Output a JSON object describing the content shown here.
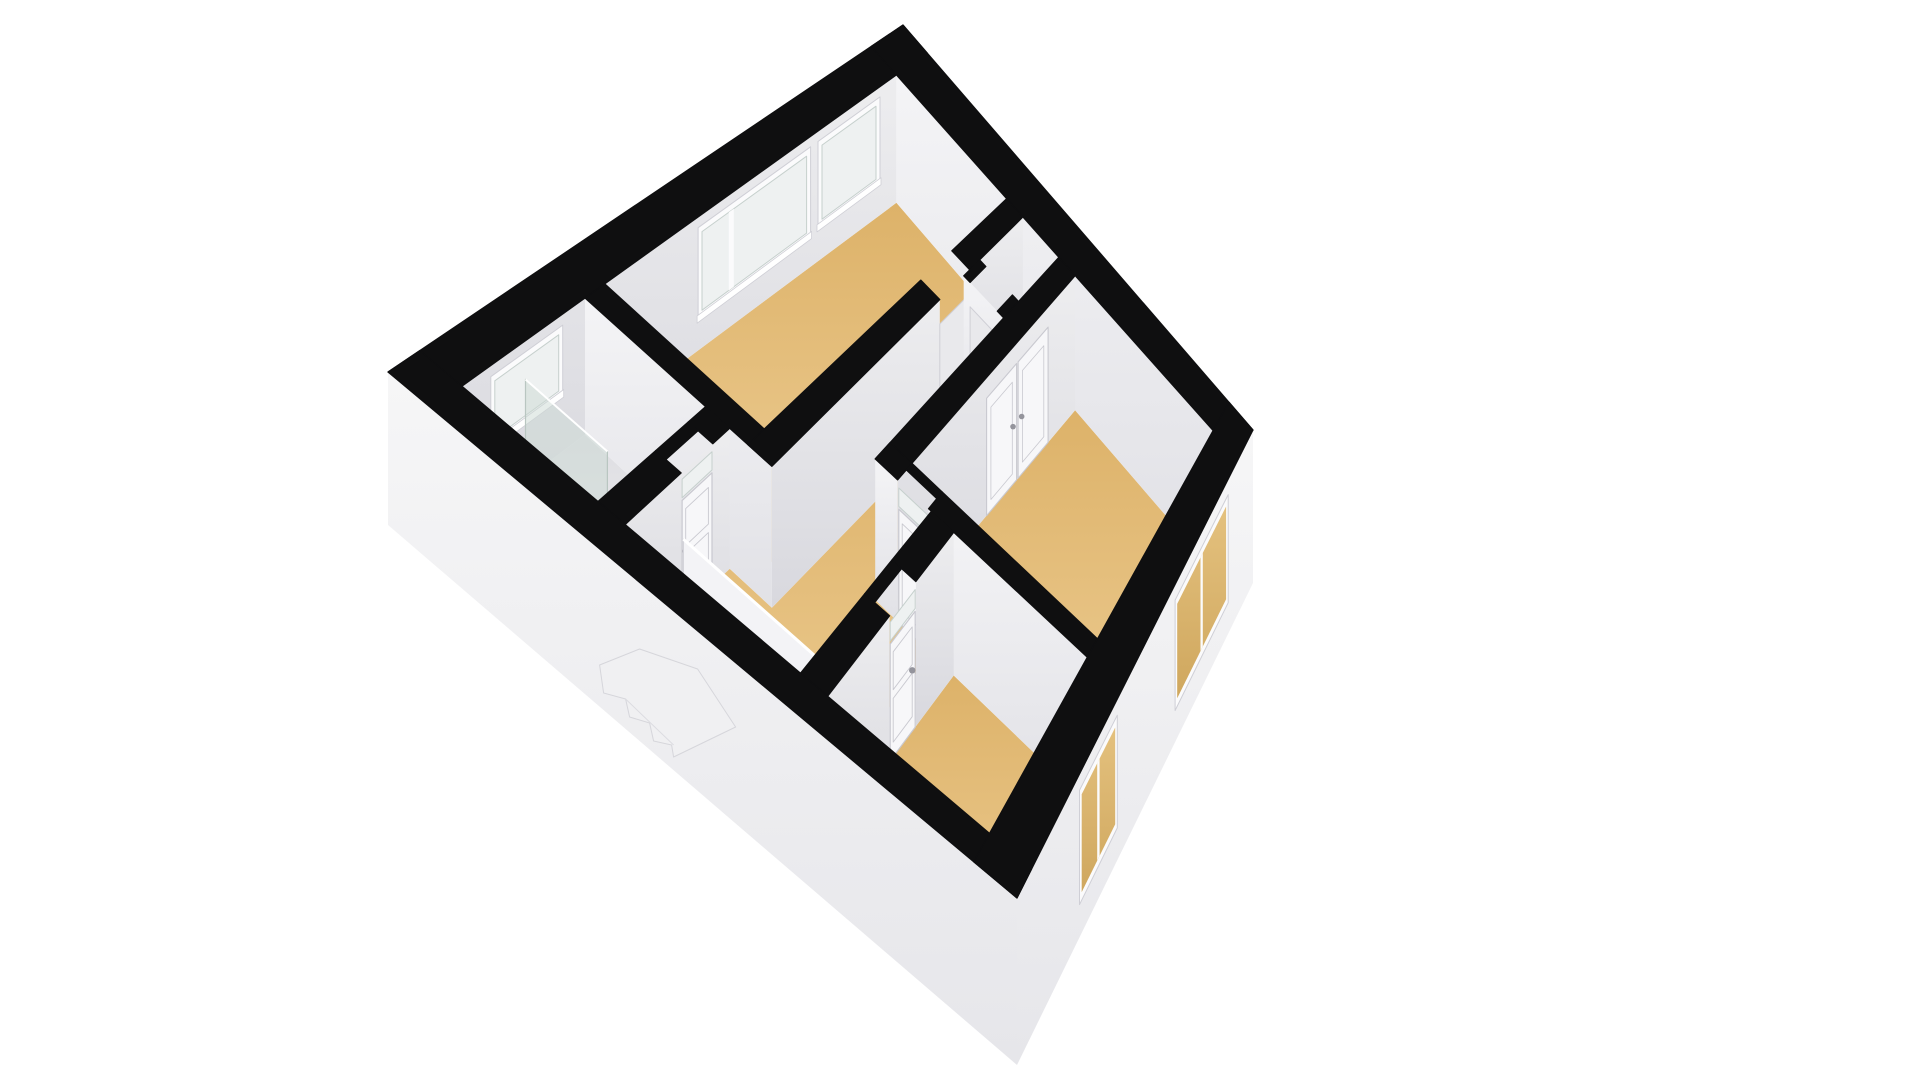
{
  "page": {
    "background": "#ffffff",
    "kind": "3d-floor-plan-render",
    "floor_label": "upper-floor"
  },
  "projection": {
    "corners": {
      "n": [
        903,
        25
      ],
      "w": [
        388,
        372
      ],
      "e": [
        1253,
        430
      ],
      "s": [
        1017,
        898
      ]
    },
    "plan_width": 10,
    "plan_depth": 9,
    "wall_px": {
      "base": 126,
      "grow": 14,
      "slab": 13
    }
  },
  "colors": {
    "band": "#0f0f10",
    "wallA_hi": "#ededef",
    "wallA_lo": "#d8d8de",
    "wallB_hi": "#f4f4f6",
    "wallB_lo": "#e1e1e6",
    "ext_hi": "#f6f6f7",
    "ext_lo": "#e6e6ea",
    "floor_hi": "#eece95",
    "floor_lo": "#ddb269",
    "bath_hi": "#f0f0f2",
    "bath_lo": "#dedee2",
    "closet_hi": "#ececee",
    "closet_lo": "#dcdce0",
    "frame": "#fbfbfc",
    "frame_edge": "#cfcfd6",
    "glass": "#eef1f1",
    "glass_edge": "#c6d0cd",
    "glass_ext_hi": "#e4c17e",
    "glass_ext_lo": "#cfa75e",
    "door": "#f7f7f9",
    "door_edge": "#c9c9d0",
    "handle": "#94949c",
    "stair_a": "#ffffff",
    "stair_b": "#f1f1f4",
    "stair_edge": "#cdcdd4",
    "opening_back": "#e9e9ec",
    "shower_glass": "rgba(203,217,212,0.5)",
    "shower_edge": "#b9c6c1",
    "fixture": "#fdfdfe",
    "fixture_edge": "#c9c9cf"
  },
  "plan": {
    "floors": [
      {
        "name": "floor-bedroom-top",
        "rect": [
          0.62,
          0.62,
          6.5,
          3.32
        ],
        "kind": "wood"
      },
      {
        "name": "floor-bathroom",
        "rect": [
          6.9,
          0.62,
          9.38,
          2.62
        ],
        "kind": "bath"
      },
      {
        "name": "floor-closet",
        "rect": [
          0.62,
          3.72,
          1.7,
          4.6
        ],
        "kind": "closet"
      },
      {
        "name": "floor-bedroom-right",
        "rect": [
          0.62,
          5.0,
          5.15,
          8.38
        ],
        "kind": "wood"
      },
      {
        "name": "floor-bedroom-bottom",
        "rect": [
          5.55,
          6.0,
          9.38,
          8.38
        ],
        "kind": "wood"
      },
      {
        "name": "floor-hallway-landing",
        "poly": [
          [
            2.1,
            3.72
          ],
          [
            6.9,
            3.72
          ],
          [
            6.9,
            3.02
          ],
          [
            9.38,
            3.02
          ],
          [
            9.38,
            5.6
          ],
          [
            5.55,
            5.6
          ],
          [
            5.55,
            4.6
          ],
          [
            2.1,
            4.6
          ]
        ],
        "kind": "wood"
      }
    ],
    "interior_windows": [
      {
        "name": "window-bedroom-top-narrow",
        "b": 0.62,
        "span": [
          0.95,
          2.2
        ],
        "sill": 0.3,
        "head": 0.9,
        "mullions": []
      },
      {
        "name": "window-bedroom-top-large",
        "b": 0.62,
        "span": [
          2.35,
          4.62
        ],
        "sill": 0.28,
        "head": 0.9,
        "mullions": [
          3.95
        ]
      },
      {
        "name": "window-bathroom",
        "b": 0.62,
        "span": [
          7.35,
          8.8
        ],
        "sill": 0.46,
        "head": 0.9,
        "mullions": []
      }
    ],
    "walls": [
      {
        "name": "wall-divider-bed-top-bath",
        "type": "B",
        "a": [
          6.5,
          6.9
        ],
        "b": [
          0.62,
          3.72
        ],
        "face_a": 6.9,
        "segments": [
          [
            0.62,
            3.72
          ]
        ]
      },
      {
        "name": "wall-bed-top-south",
        "type": "A",
        "b": [
          3.32,
          3.72
        ],
        "a": [
          0.62,
          6.9
        ],
        "face_b": 3.72,
        "segments": [
          [
            0.62,
            1.95
          ],
          [
            2.7,
            6.9
          ]
        ],
        "opening": [
          1.95,
          2.7
        ]
      },
      {
        "name": "wall-bathroom-south",
        "type": "A",
        "b": [
          2.62,
          3.02
        ],
        "a": [
          6.9,
          9.38
        ],
        "face_b": 3.02,
        "segments": [
          [
            6.9,
            7.3
          ],
          [
            8.05,
            9.38
          ]
        ],
        "door_gap": [
          7.3,
          8.05
        ]
      },
      {
        "name": "wall-closet-side",
        "type": "B",
        "a": [
          1.7,
          2.1
        ],
        "b": [
          3.72,
          4.6
        ],
        "face_a": 2.1,
        "segments": [
          [
            3.72,
            3.86
          ],
          [
            4.46,
            4.6
          ]
        ],
        "opening": [
          3.86,
          4.46
        ]
      },
      {
        "name": "wall-bed-right-north",
        "type": "A",
        "b": [
          4.6,
          5.0
        ],
        "a": [
          0.62,
          5.55
        ],
        "face_b": 5.0,
        "segments": [
          [
            0.62,
            5.55
          ]
        ]
      },
      {
        "name": "wall-bed-right-west",
        "type": "B",
        "a": [
          5.15,
          5.55
        ],
        "b": [
          4.6,
          8.38
        ],
        "face_a": 5.55,
        "segments": [
          [
            4.6,
            5.0
          ],
          [
            5.55,
            8.38
          ]
        ],
        "door_gap": [
          5.0,
          5.55
        ]
      },
      {
        "name": "wall-bed-bottom-north",
        "type": "A",
        "b": [
          5.6,
          6.0
        ],
        "a": [
          5.55,
          9.38
        ],
        "face_b": 6.0,
        "segments": [
          [
            5.55,
            6.7
          ],
          [
            7.5,
            9.38
          ]
        ],
        "door_gap": [
          6.7,
          7.5
        ]
      }
    ],
    "doors": [
      {
        "name": "door-bathroom",
        "plane": "A",
        "line": 3.02,
        "span": [
          7.32,
          8.03
        ],
        "transom": true,
        "handle_at": 0.88
      },
      {
        "name": "door-bedroom-right",
        "plane": "B",
        "line": 5.55,
        "span": [
          5.02,
          5.53
        ],
        "transom": true,
        "handle_at": 0.12
      },
      {
        "name": "door-bedroom-bottom",
        "plane": "A",
        "line": 6.0,
        "span": [
          6.72,
          7.48
        ],
        "transom": true,
        "handle_at": 0.12
      }
    ],
    "closet_double_doors": {
      "name": "closet-doors-bedroom-right",
      "plane_b": 5.0,
      "span": [
        1.35,
        3.1
      ],
      "height": 0.85
    },
    "stairs": {
      "name": "staircase-winder",
      "void": [
        8.0,
        3.02,
        9.38,
        5.42
      ],
      "edges": [
        [
          [
            8.0,
            3.02
          ],
          [
            9.38,
            3.02
          ]
        ],
        [
          [
            8.0,
            3.34
          ],
          [
            9.38,
            3.38
          ]
        ],
        [
          [
            8.0,
            3.65
          ],
          [
            9.38,
            3.74
          ]
        ],
        [
          [
            8.0,
            3.95
          ],
          [
            9.38,
            4.12
          ]
        ],
        [
          [
            8.0,
            3.95
          ],
          [
            9.38,
            4.78
          ]
        ],
        [
          [
            8.0,
            3.95
          ],
          [
            9.02,
            5.42
          ]
        ],
        [
          [
            8.0,
            3.95
          ],
          [
            8.42,
            5.42
          ]
        ],
        [
          [
            8.0,
            3.95
          ],
          [
            8.0,
            5.42
          ]
        ]
      ],
      "drops": [
        0,
        7,
        15,
        24,
        35,
        47,
        60,
        72
      ],
      "balustrade": {
        "a": 8.0,
        "b": [
          3.02,
          5.42
        ],
        "height": 0.52
      }
    },
    "fixtures": {
      "toilet": {
        "name": "toilet",
        "center": [
          8.92,
          1.08
        ],
        "rx": 0.34,
        "ry": 0.26,
        "tank": [
          9.12,
          0.78,
          9.38,
          1.38
        ]
      },
      "shower": {
        "name": "shower-glass-panel",
        "a": 8.1,
        "b": [
          0.62,
          1.9
        ],
        "height": 0.72,
        "tray": [
          8.1,
          0.62,
          9.38,
          1.9
        ]
      }
    },
    "exterior_windows": [
      {
        "name": "window-ext-bedroom-bottom",
        "span": [
          5.75,
          7.35
        ],
        "top": 0.1,
        "sill": 0.8,
        "mullions": 1
      },
      {
        "name": "window-ext-bedroom-right",
        "span": [
          1.05,
          3.3
        ],
        "top": 0.1,
        "sill": 0.8,
        "mullions": 1
      }
    ],
    "exterior_walls": {
      "nw": [
        0,
        10,
        0,
        0.62
      ],
      "ne": [
        0,
        0.62,
        0,
        9
      ],
      "sw": [
        9.38,
        10,
        0,
        9
      ],
      "se": [
        0,
        10,
        8.38,
        9
      ]
    },
    "stair_artifact": {
      "name": "exterior-stair-artifact",
      "anchor_b": 3.6,
      "anchor_s": 0.42,
      "rel": [
        [
          0,
          0
        ],
        [
          -40,
          16
        ],
        [
          -36,
          44
        ],
        [
          -14,
          50
        ],
        [
          -10,
          68
        ],
        [
          10,
          74
        ],
        [
          14,
          92
        ],
        [
          32,
          96
        ],
        [
          34,
          108
        ],
        [
          96,
          78
        ],
        [
          58,
          20
        ]
      ]
    }
  }
}
